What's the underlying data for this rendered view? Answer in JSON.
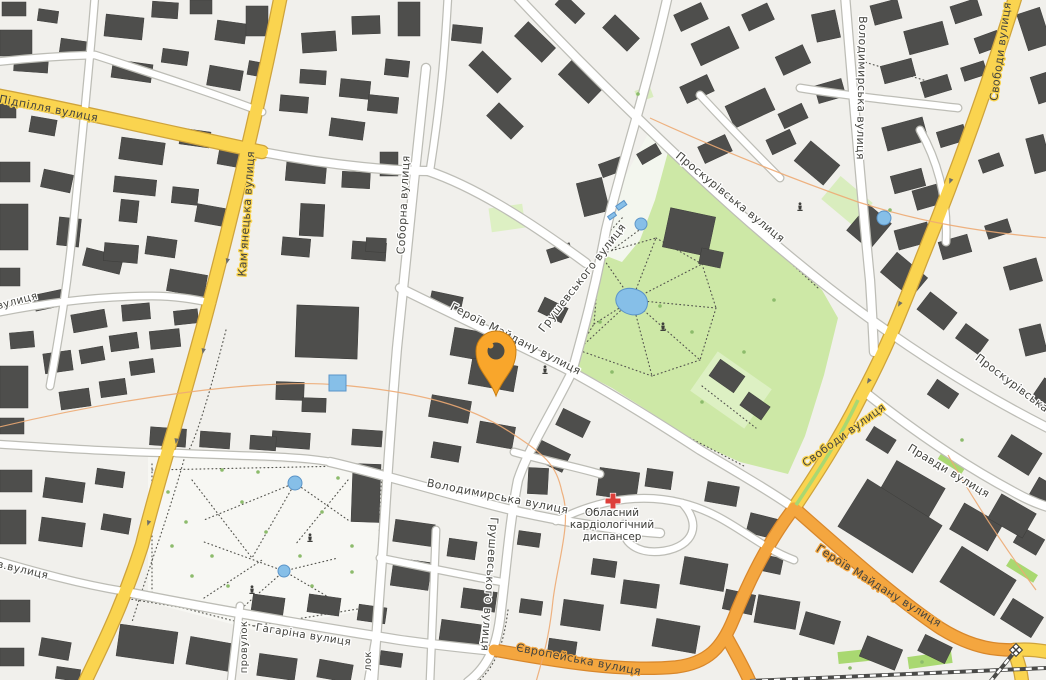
{
  "map": {
    "colors": {
      "background": "#F1F0EC",
      "building": "#4E4E4C",
      "building_outline": "#3D3D3B",
      "road_fill": "#FFFFFF",
      "road_casing": "#BDBDB6",
      "road_yellow": "#FAD44F",
      "road_yellow_casing": "#CEA33C",
      "road_orange": "#F4A63F",
      "road_orange_casing": "#D8872B",
      "park": "#CDE8A6",
      "grass_light": "#DDF0C3",
      "grass_bright": "#A9D871",
      "water": "#86BFE8",
      "water_outline": "#5B94C8",
      "plaza": "#F7F7F3",
      "contour": "#EDAA73",
      "marker": "#F9A62B",
      "marker_hole": "#4B4B46",
      "hospital_cross": "#DD3F3A",
      "label_text": "#44443F"
    },
    "marker": {
      "x": 496,
      "y": 351
    },
    "street_labels": [
      {
        "name": "Підпілля вулиця",
        "x": 48,
        "y": 112,
        "r": 11,
        "halo": "yellow",
        "size": 11
      },
      {
        "name": "Кам'янецька вулиця",
        "x": 250,
        "y": 214,
        "r": -86,
        "halo": "yellow",
        "size": 11
      },
      {
        "name": "Соборна вулиця",
        "x": 407,
        "y": 205,
        "r": -87,
        "halo": "white",
        "size": 11
      },
      {
        "name": "Грушевського вулиця",
        "x": 585,
        "y": 280,
        "r": -52,
        "halo": "white",
        "size": 11
      },
      {
        "name": "Героїв Майдану вулиця",
        "x": 514,
        "y": 342,
        "r": 27,
        "halo": "white",
        "size": 11
      },
      {
        "name": "Проскурівська вулиця",
        "x": 728,
        "y": 200,
        "r": 39,
        "halo": "white",
        "size": 11
      },
      {
        "name": "Володимирська вулиця",
        "x": 858,
        "y": 88,
        "r": 91,
        "halo": "white",
        "size": 11
      },
      {
        "name": "Свободи вулиця",
        "x": 1004,
        "y": 52,
        "r": -82,
        "halo": "yellow",
        "size": 11
      },
      {
        "name": "Проскурівська",
        "x": 1010,
        "y": 386,
        "r": 37,
        "halo": "white",
        "size": 11
      },
      {
        "name": "Свободи вулиця",
        "x": 846,
        "y": 438,
        "r": -36,
        "halo": "yellow",
        "size": 11
      },
      {
        "name": "Правди вулиця",
        "x": 947,
        "y": 474,
        "r": 31,
        "halo": "white",
        "size": 11
      },
      {
        "name": "Володимирська вулиця",
        "x": 497,
        "y": 500,
        "r": 11,
        "halo": "white",
        "size": 11
      },
      {
        "name": "Грушевського вулиця",
        "x": 486,
        "y": 584,
        "r": 94,
        "halo": "white",
        "size": 11
      },
      {
        "name": "Героїв Майдану вулиця",
        "x": 877,
        "y": 589,
        "r": 32,
        "halo": "orange",
        "size": 11
      },
      {
        "name": "Європейська вулиця",
        "x": 578,
        "y": 663,
        "r": 11,
        "halo": "orange",
        "size": 11
      },
      {
        "name": "Гагаріна вулиця",
        "x": 303,
        "y": 638,
        "r": 9,
        "halo": "white",
        "size": 10.5
      },
      {
        "name": "провулок",
        "x": 247,
        "y": 647,
        "r": -90,
        "halo": "white",
        "size": 10
      },
      {
        "name": "лок",
        "x": 371,
        "y": 661,
        "r": -90,
        "halo": "white",
        "size": 10
      },
      {
        "name": "вулиця",
        "x": 18,
        "y": 304,
        "r": -15,
        "halo": "white",
        "size": 10.5
      },
      {
        "name": "в.вулиця",
        "x": 22,
        "y": 573,
        "r": 13,
        "halo": "white",
        "size": 10.5
      }
    ],
    "poi": {
      "hospital": {
        "lines": [
          "Обласний",
          "кардіологічний",
          "диспансер"
        ],
        "x": 612,
        "y": 516,
        "line_height": 12,
        "icon": "red-cross",
        "icon_x": 613,
        "icon_y": 501
      }
    }
  }
}
